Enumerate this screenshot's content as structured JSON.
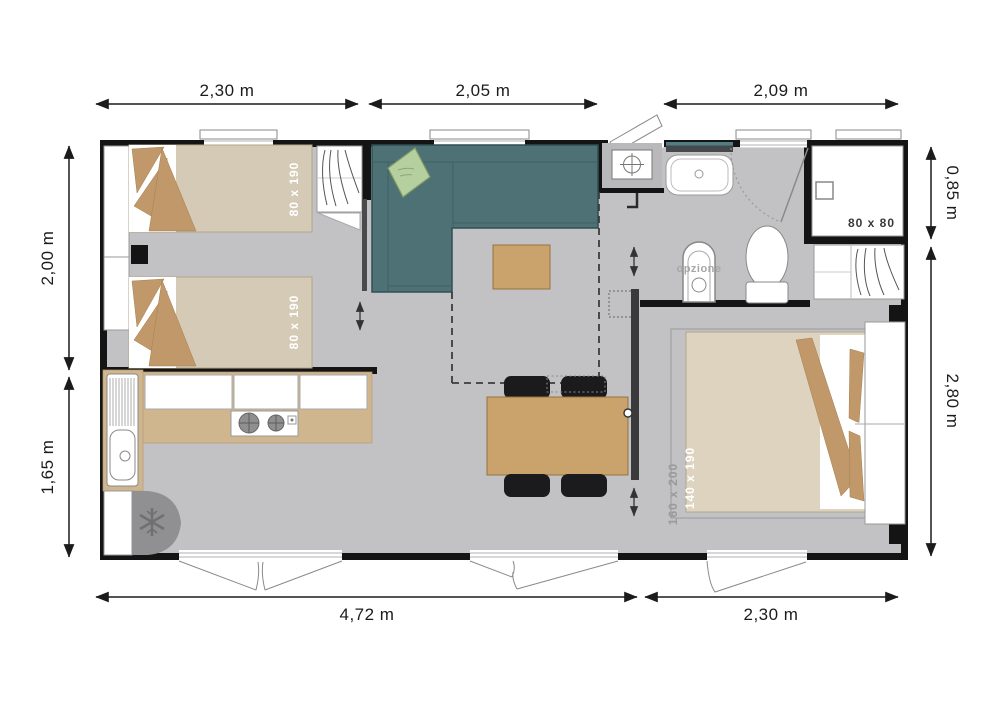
{
  "dimensions": {
    "top": [
      {
        "label": "2,30 m"
      },
      {
        "label": "2,05 m"
      },
      {
        "label": "2,09 m"
      }
    ],
    "bottom": [
      {
        "label": "4,72 m"
      },
      {
        "label": "2,30 m"
      }
    ],
    "left": [
      {
        "label": "2,00 m"
      },
      {
        "label": "1,65 m"
      }
    ],
    "right": [
      {
        "label": "0,85 m"
      },
      {
        "label": "2,80 m"
      }
    ]
  },
  "labels": {
    "single_bed_1": "80 x 190",
    "single_bed_2": "80 x 190",
    "double_bed": "140 x 190",
    "double_bed_footprint": "160 x 200",
    "shower": "80 x 80",
    "bidet_option": "opzione"
  },
  "colors": {
    "wall": "#141414",
    "floor": "#c2c2c4",
    "bed_beige": "#d5cab6",
    "tan_accent": "#c0986a",
    "wood": "#c9a26c",
    "counter": "#cfb68f",
    "sofa_teal": "#4d7175",
    "pillow_green": "#b6cf9f",
    "chair": "#1b1b1d",
    "fridge": "#909092",
    "dimension_text": "#1b1b1b",
    "label_muted": "#9a9a9a"
  }
}
